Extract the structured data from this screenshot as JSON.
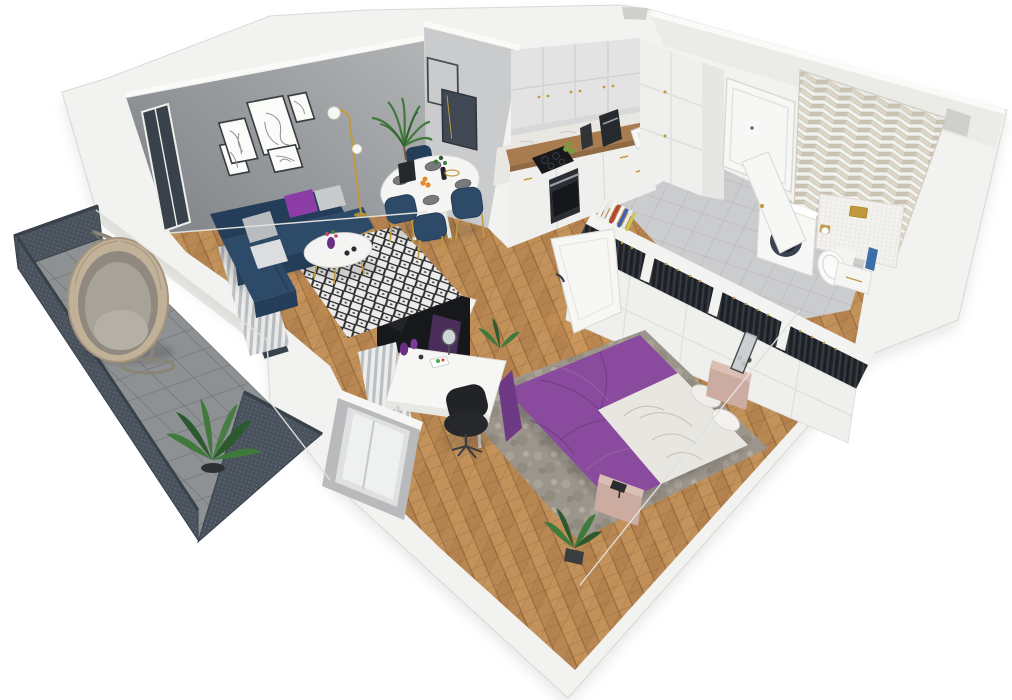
{
  "scene": {
    "label": "3D cutaway floor plan rendering of a one-bedroom apartment with balcony",
    "background": "#ffffff"
  },
  "palette": {
    "wall": "#f2f2f0",
    "wall_edge": "#dcdcd8",
    "wall_shade": "#e9e9e6",
    "wall_dark": "#cfcfcc",
    "gray_a": "#84888c",
    "gray_b": "#b2b4b5",
    "frame_dark": "#3a3d41",
    "wood": "#b4824e",
    "wood_light": "#cf9f66",
    "wood_dark": "#8c6136",
    "tile": "#cbccce",
    "tile_line": "#b7b8bb",
    "balc": "#8e9193",
    "balc_line": "#77797c",
    "railing": "#49525c",
    "railing_dark": "#39424b",
    "perf_dot": "#6a737d",
    "sofa": "#2e4a69",
    "sofa_dark": "#243d59",
    "sofa_light": "#3c5a7d",
    "pillow_purple": "#8c3ea6",
    "pillow_gray": "#c8cacc",
    "bed_purple": "#8a4b9e",
    "bed_dark": "#6f3a85",
    "bed_light": "#a169b3",
    "blanket": "#e8e6e1",
    "blanket_shade": "#c6c3bd",
    "rug_base": "#ecebe9",
    "rug_dark": "#2a2c2e",
    "rug_bed": "#9c958c",
    "pink": "#ccaba1",
    "pink_light": "#dcbfb4",
    "gold": "#c19a3f",
    "glass": "#39424a",
    "door": "#f7f7f5",
    "cab": "#efefed",
    "cab_gray": "#e2e3e2",
    "cab_shade": "#d7d8d7",
    "counter": "#a87c4f",
    "marble": "#e9e7e2",
    "appl": "#2b2e33",
    "appl_dark": "#17191c",
    "steel": "#9aa0a6",
    "clothes": "#23262b",
    "clothes_hi": "#3a4048",
    "chev_a": "#ded7c9",
    "chev_b": "#cbc4b5",
    "chev_line": "#bdb5a6",
    "mosaic": "#f3f2ef",
    "mosaic_line": "#dad8d2",
    "green": "#3f7a3c",
    "green_dark": "#2c5a2e",
    "chair_black": "#26282b",
    "purple_panel": "#4b2d59",
    "tv": "#17181b",
    "rattan": "#c2b199",
    "rattan_dark": "#a08f77",
    "cushion": "#a8a398",
    "shadow": "#2a2a30",
    "orange": "#e8882b"
  },
  "rooms": {
    "living_room": {
      "items": [
        "gray-gallery-wall",
        "five-picture-frames",
        "navy-sectional-sofa",
        "purple-pillow",
        "gray-pillows",
        "diamond-rug",
        "round-coffee-table",
        "purple-vase",
        "floor-lamp",
        "potted-palm",
        "striped-curtains",
        "balcony-glass-door",
        "wall-frames-pair"
      ]
    },
    "dining": {
      "items": [
        "oval-dining-table",
        "four-navy-chairs",
        "plates",
        "orange-fruit",
        "table-plant"
      ]
    },
    "kitchen": {
      "items": [
        "upper-cabinets",
        "marble-backsplash",
        "wood-countertop",
        "induction-cooktop",
        "built-in-oven",
        "coffee-machine",
        "grinder",
        "sink",
        "gold-faucet",
        "tall-cabinets",
        "green-apples"
      ]
    },
    "hallway": {
      "items": [
        "gray-tile-floor",
        "entry-door",
        "open-bathroom-door",
        "wall-vent-notch"
      ]
    },
    "bathroom": {
      "items": [
        "herringbone-accent-wall",
        "mosaic-half-wall",
        "washing-machine",
        "wall-hung-toilet",
        "gold-flush-plate",
        "gold-paper-holder",
        "bench-vanity",
        "blue-towel"
      ]
    },
    "closet": {
      "items": [
        "clothes-racks",
        "hanging-dark-clothes",
        "white-cabinet-fronts",
        "books-row",
        "open-bedroom-door"
      ]
    },
    "bedroom": {
      "items": [
        "purple-double-bed",
        "white-bedding",
        "pillows",
        "mottled-rug",
        "pink-nightstands",
        "table-lamp",
        "desk",
        "office-chair",
        "tv-screen",
        "purple-accent-panel",
        "desk-curtain",
        "window-bay",
        "floor-plants",
        "standing-mirror"
      ]
    },
    "balcony": {
      "items": [
        "hanging-egg-chair",
        "perforated-railing-panels",
        "concrete-tile-floor",
        "large-plant"
      ]
    }
  }
}
